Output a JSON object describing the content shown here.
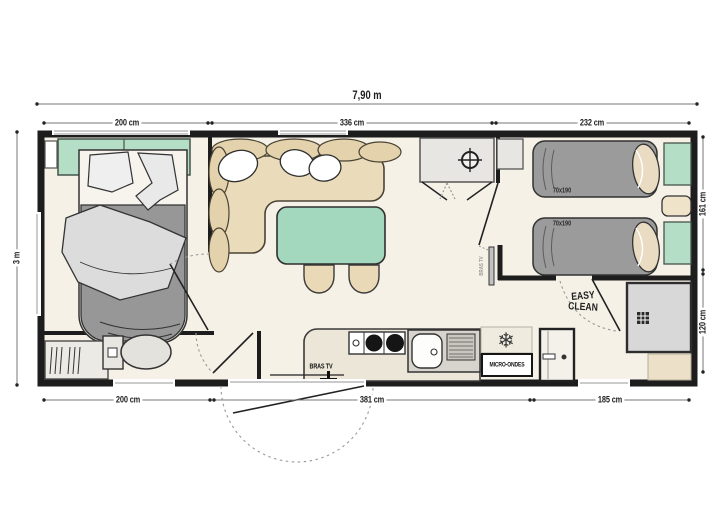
{
  "diagram": {
    "type": "floor-plan",
    "subject": "Mobile home two-bedroom floor plan"
  },
  "dimensions": {
    "overall_width": "7,90 m",
    "overall_depth": "3 m",
    "top": [
      "200 cm",
      "336 cm",
      "232 cm"
    ],
    "bottom": [
      "200 cm",
      "381 cm",
      "185 cm"
    ],
    "right": [
      "161 cm",
      "120 cm"
    ]
  },
  "labels": {
    "bed1": "70x190",
    "bed2": "70x190",
    "tv_bracket_kitchen": "BRAS TV",
    "tv_bracket_bedroom": "BRAS TV",
    "microwave": "MICRO-ONDES",
    "logo_top": "EASY",
    "logo_bottom": "CLEAN"
  },
  "icons": {
    "snowflake": "❄"
  },
  "colors": {
    "wall": "#1d1d1d",
    "floor": "#f6f1e7",
    "green_furniture": "#a8dac1",
    "beige_furniture": "#eadcba",
    "gray_bed": "#9b9b9b",
    "shower_gray": "#d8d8d8"
  }
}
